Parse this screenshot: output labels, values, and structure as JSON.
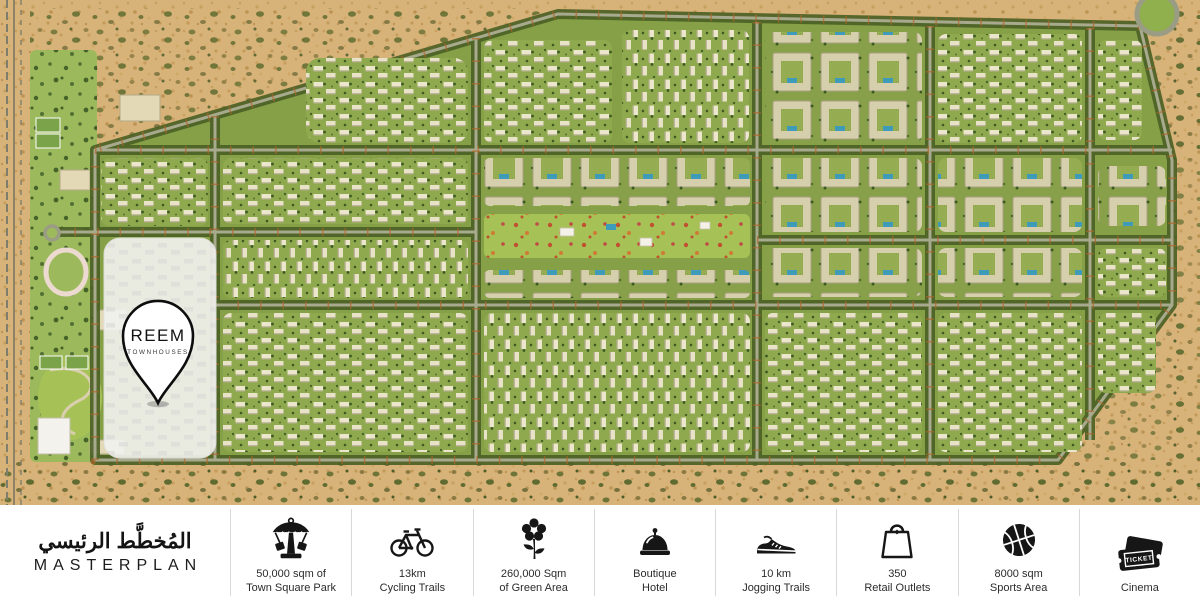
{
  "map": {
    "pin": {
      "title": "REEM",
      "subtitle": "TOWNHOUSES"
    }
  },
  "footer": {
    "title_arabic": "المُخطَّط الرئيسي",
    "title_english": "MASTERPLAN",
    "ticket_text": "TICKET",
    "items": [
      {
        "icon": "carousel-icon",
        "line1": "50,000 sqm of",
        "line2": "Town Square Park"
      },
      {
        "icon": "bicycle-icon",
        "line1": "13km",
        "line2": "Cycling Trails"
      },
      {
        "icon": "flower-icon",
        "line1": "260,000 Sqm",
        "line2": "of Green Area"
      },
      {
        "icon": "bell-icon",
        "line1": "Boutique",
        "line2": "Hotel"
      },
      {
        "icon": "sneaker-icon",
        "line1": "10 km",
        "line2": "Jogging Trails"
      },
      {
        "icon": "shopping-bag-icon",
        "line1": "350",
        "line2": "Retail Outlets"
      },
      {
        "icon": "basketball-icon",
        "line1": "8000 sqm",
        "line2": "Sports Area"
      },
      {
        "icon": "ticket-icon",
        "line1": "Cinema",
        "line2": ""
      }
    ]
  },
  "colors": {
    "sand": "#d8b379",
    "development_green": "#85a047",
    "road_trees": "#4c6126",
    "pool_blue": "#3e9cba",
    "autumn_accent": "#b06427",
    "parcel_highlight": "#f2f2ef"
  }
}
